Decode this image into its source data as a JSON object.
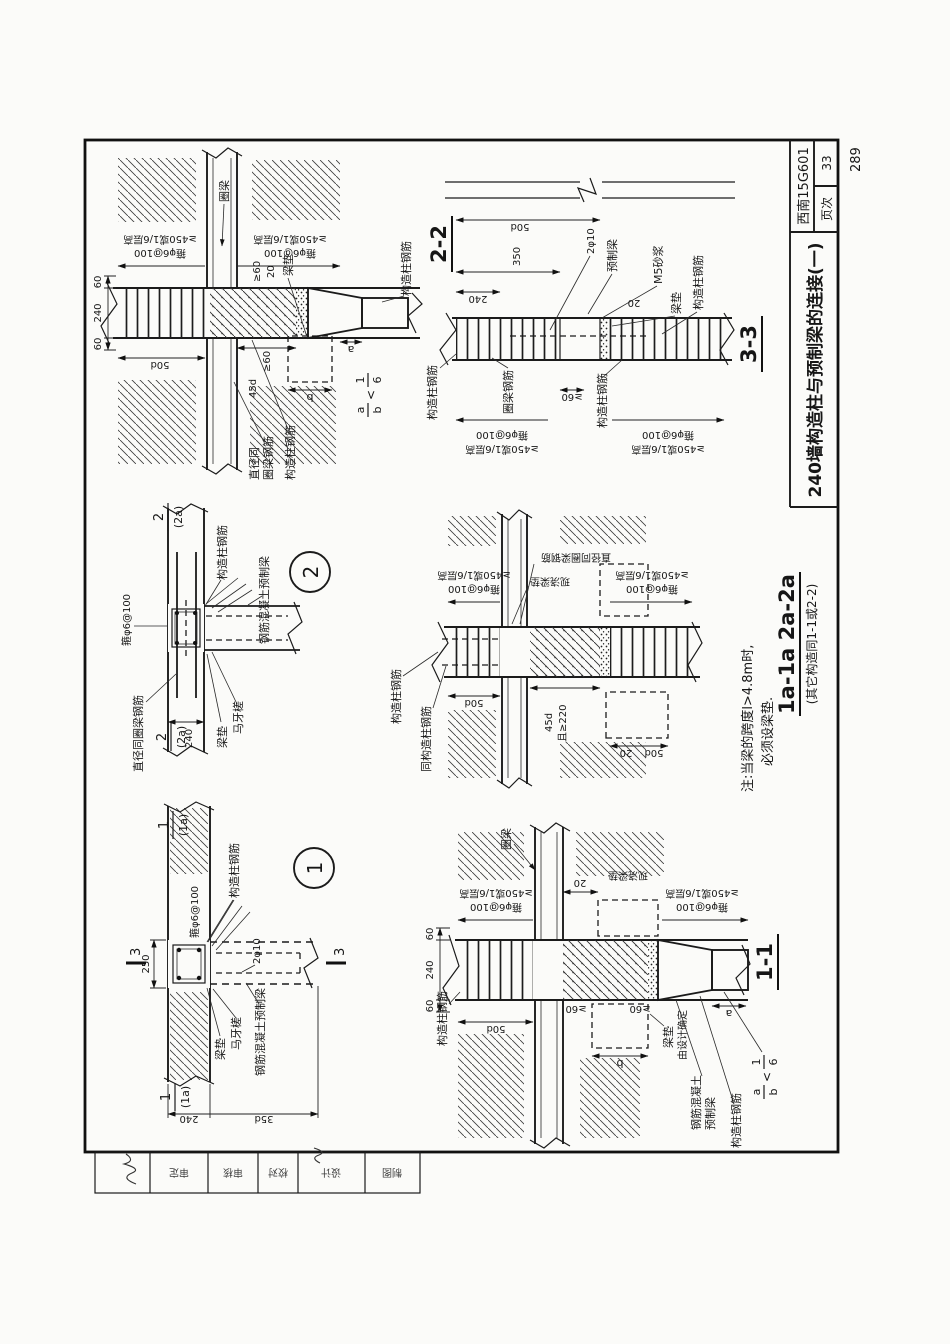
{
  "page": {
    "number": "289"
  },
  "title_block": {
    "title": "240墙构造柱与预制梁的连接(一)",
    "atlas_no": "西南15G601",
    "page_label": "页次",
    "page_no": "33"
  },
  "approval": {
    "cells": [
      "",
      "审定",
      "审核",
      "校对",
      "设计",
      "制图"
    ]
  },
  "terms": {
    "gzz_rebar": "构造柱钢筋",
    "same_gzz_rebar": "同构造柱钢筋",
    "stirrup": "箍φ6@100",
    "zone": "≥450或1/6层高",
    "ring_beam": "圈梁",
    "ring_beam_rebar": "圈梁钢筋",
    "same_dia_1": "直径同",
    "same_dia_2": "圈梁钢筋",
    "same_dia": "直径同圈梁钢筋",
    "precast": "预制梁",
    "rc_precast": "钢筋混凝土预制梁",
    "rc_precast_1": "钢筋混凝土",
    "rc_precast_2": "预制梁",
    "pad": "梁垫",
    "pad_cast": "现浇梁垫",
    "pad_design_1": "梁垫",
    "pad_design_2": "由设计确定",
    "tooth": "马牙槎",
    "mortar": "M5砂浆",
    "bars_2phi10": "2φ10",
    "d35": "35d",
    "d45": "45d",
    "d50": "50d",
    "n20": "20",
    "n60": "60",
    "n240": "240",
    "n250": "250",
    "n350": "350",
    "ge60": "≥60",
    "ge220": "且≥220",
    "a": "a",
    "b": "b",
    "lt": "<",
    "one": "1",
    "six": "6"
  },
  "views": {
    "d1": {
      "callout": "1",
      "mark_top": "1",
      "mark_bot": "(1a)",
      "sec": "3"
    },
    "d2": {
      "callout": "2",
      "mark_top": "2",
      "mark_bot": "(2a)"
    },
    "s22": {
      "title": "2-2"
    },
    "s33": {
      "title": "3-3"
    },
    "s11": {
      "title": "1-1"
    },
    "s1a": {
      "title": "1a-1a 2a-2a",
      "subtitle": "(其它构造同1-1或2-2)"
    }
  },
  "note": {
    "line1": "注:当梁的跨度l>4.8m时,",
    "line2": "必须设梁垫."
  }
}
